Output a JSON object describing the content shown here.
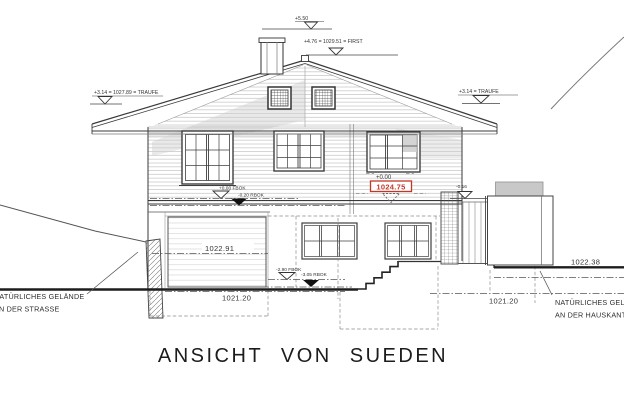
{
  "title": "ANSICHT VON SUEDEN",
  "colors": {
    "line": "#3a3a3a",
    "shade": "#cfcfcf",
    "red": "#c43527"
  },
  "levels": {
    "chimney_top": "+5.50",
    "ridge_first": "+4.76 = 1029.51 = FIRST",
    "eave_left": "+3.14 = 1027.89 = TRAUFE",
    "eave_right": "+3.14 = TRAUFE",
    "ffl_ground": "+0.00 FBOK",
    "rbok_ground": "-0.20 RBOK",
    "zero": "+0.00",
    "zero_absolute": "1024.75",
    "annex": "-0.16",
    "ffl_basement": "-2.90 FBOK",
    "rbok_basement": "-3.05 RBOK",
    "garage": "1022.91",
    "street": "1021.20",
    "ground_right_low": "1021.20",
    "ground_right": "1022.38"
  },
  "notes": {
    "left_line1": "NATÜRLICHES GELÄNDE",
    "left_line2": "AN DER STRASSE",
    "right_line1": "NATÜRLICHES GELÄNDE",
    "right_line2": "AN DER HAUSKANTE"
  }
}
